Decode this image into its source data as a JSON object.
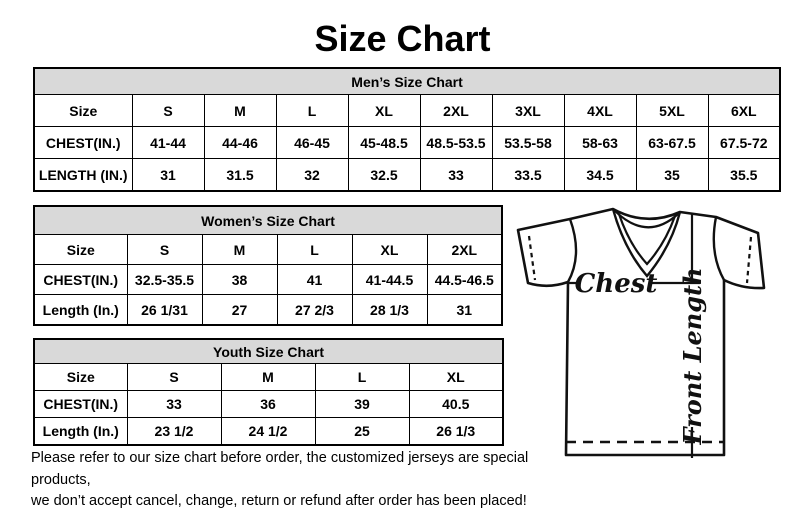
{
  "page": {
    "title": "Size Chart"
  },
  "colors": {
    "header_bg": "#d9d9d9",
    "border": "#000000",
    "line": "#111111"
  },
  "tables": {
    "mens": {
      "title": "Men’s Size Chart",
      "columns": [
        "Size",
        "S",
        "M",
        "L",
        "XL",
        "2XL",
        "3XL",
        "4XL",
        "5XL",
        "6XL"
      ],
      "rows": [
        {
          "label": "CHEST(IN.)",
          "values": [
            "41-44",
            "44-46",
            "46-45",
            "45-48.5",
            "48.5-53.5",
            "53.5-58",
            "58-63",
            "63-67.5",
            "67.5-72"
          ]
        },
        {
          "label": "LENGTH (IN.)",
          "values": [
            "31",
            "31.5",
            "32",
            "32.5",
            "33",
            "33.5",
            "34.5",
            "35",
            "35.5"
          ]
        }
      ]
    },
    "womens": {
      "title": "Women’s Size Chart",
      "columns": [
        "Size",
        "S",
        "M",
        "L",
        "XL",
        "2XL"
      ],
      "rows": [
        {
          "label": "CHEST(IN.)",
          "values": [
            "32.5-35.5",
            "38",
            "41",
            "41-44.5",
            "44.5-46.5"
          ]
        },
        {
          "label": "Length (In.)",
          "values": [
            "26 1/31",
            "27",
            "27 2/3",
            "28 1/3",
            "31"
          ]
        }
      ]
    },
    "youth": {
      "title": "Youth Size Chart",
      "columns": [
        "Size",
        "S",
        "M",
        "L",
        "XL"
      ],
      "rows": [
        {
          "label": "CHEST(IN.)",
          "values": [
            "33",
            "36",
            "39",
            "40.5"
          ]
        },
        {
          "label": "Length (In.)",
          "values": [
            "23 1/2",
            "24 1/2",
            "25",
            "26 1/3"
          ]
        }
      ]
    }
  },
  "diagram": {
    "chest_label": "Chest",
    "length_label": "Front Length"
  },
  "footer": {
    "line1": "Please refer to our size chart before order, the customized jerseys are special products,",
    "line2": "we don’t accept cancel, change, return or refund after order has been placed!"
  }
}
